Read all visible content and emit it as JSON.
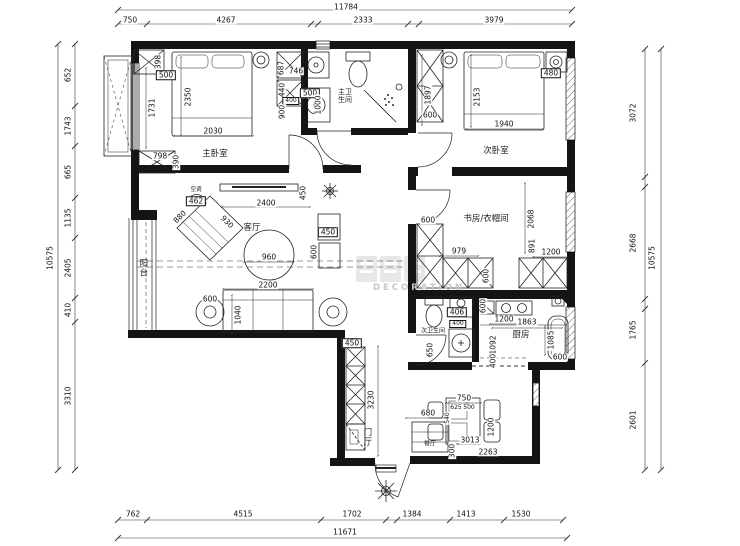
{
  "watermark": {
    "text": "DECORATION"
  },
  "rooms": [
    {
      "label": "主卧室",
      "x": 215,
      "y": 155,
      "cls": ""
    },
    {
      "label": "次卧室",
      "x": 496,
      "y": 152,
      "cls": ""
    },
    {
      "label": "主卫生间",
      "x": 345,
      "y": 96,
      "cls": "wrap"
    },
    {
      "label": "次卫生间",
      "x": 433,
      "y": 332,
      "cls": "sm"
    },
    {
      "label": "书房/衣帽间",
      "x": 486,
      "y": 220,
      "cls": ""
    },
    {
      "label": "厨房",
      "x": 521,
      "y": 336,
      "cls": ""
    },
    {
      "label": "客厅",
      "x": 252,
      "y": 229,
      "cls": ""
    },
    {
      "label": "餐厅",
      "x": 430,
      "y": 445,
      "cls": "sm"
    },
    {
      "label": "阳台",
      "x": 142,
      "y": 268,
      "cls": "vert"
    },
    {
      "label": "门厅",
      "x": 366,
      "y": 437,
      "cls": "vert"
    },
    {
      "label": "空调",
      "x": 196,
      "y": 190,
      "cls": "tiny"
    }
  ],
  "dims": [
    {
      "t": "11784",
      "x": 346,
      "y": 7
    },
    {
      "t": "750",
      "x": 130,
      "y": 20
    },
    {
      "t": "4267",
      "x": 226,
      "y": 20
    },
    {
      "t": "2333",
      "x": 363,
      "y": 20
    },
    {
      "t": "3979",
      "x": 494,
      "y": 20
    },
    {
      "t": "762",
      "x": 133,
      "y": 514
    },
    {
      "t": "4515",
      "x": 243,
      "y": 514
    },
    {
      "t": "1702",
      "x": 352,
      "y": 514
    },
    {
      "t": "1384",
      "x": 412,
      "y": 514
    },
    {
      "t": "1413",
      "x": 466,
      "y": 514
    },
    {
      "t": "1530",
      "x": 521,
      "y": 514
    },
    {
      "t": "11671",
      "x": 345,
      "y": 532
    },
    {
      "t": "652",
      "x": 68,
      "y": 75,
      "o": "v"
    },
    {
      "t": "1743",
      "x": 68,
      "y": 126,
      "o": "v"
    },
    {
      "t": "665",
      "x": 68,
      "y": 172,
      "o": "v"
    },
    {
      "t": "1135",
      "x": 68,
      "y": 218,
      "o": "v"
    },
    {
      "t": "2405",
      "x": 68,
      "y": 268,
      "o": "v"
    },
    {
      "t": "410",
      "x": 68,
      "y": 310,
      "o": "v"
    },
    {
      "t": "3310",
      "x": 68,
      "y": 396,
      "o": "v"
    },
    {
      "t": "10575",
      "x": 50,
      "y": 258,
      "o": "v"
    },
    {
      "t": "3072",
      "x": 633,
      "y": 113,
      "o": "v"
    },
    {
      "t": "2668",
      "x": 633,
      "y": 243,
      "o": "v"
    },
    {
      "t": "1765",
      "x": 633,
      "y": 330,
      "o": "v"
    },
    {
      "t": "2601",
      "x": 633,
      "y": 420,
      "o": "v"
    },
    {
      "t": "10575",
      "x": 652,
      "y": 258,
      "o": "v"
    },
    {
      "t": "398",
      "x": 158,
      "y": 62,
      "o": "v"
    },
    {
      "t": "500",
      "x": 166,
      "y": 75,
      "box": true
    },
    {
      "t": "1731",
      "x": 152,
      "y": 108,
      "o": "v"
    },
    {
      "t": "2350",
      "x": 188,
      "y": 97,
      "o": "v"
    },
    {
      "t": "2030",
      "x": 213,
      "y": 131
    },
    {
      "t": "798",
      "x": 160,
      "y": 156
    },
    {
      "t": "390",
      "x": 176,
      "y": 162,
      "o": "v"
    },
    {
      "t": "687",
      "x": 281,
      "y": 68,
      "o": "v"
    },
    {
      "t": "746",
      "x": 296,
      "y": 71
    },
    {
      "t": "440",
      "x": 282,
      "y": 90,
      "o": "v"
    },
    {
      "t": "400",
      "x": 291,
      "y": 101,
      "box": true,
      "s": true
    },
    {
      "t": "900",
      "x": 282,
      "y": 112,
      "o": "v"
    },
    {
      "t": "500",
      "x": 310,
      "y": 93,
      "box": true
    },
    {
      "t": "1000",
      "x": 318,
      "y": 105,
      "o": "v"
    },
    {
      "t": "1897",
      "x": 428,
      "y": 95,
      "o": "v"
    },
    {
      "t": "600",
      "x": 430,
      "y": 115
    },
    {
      "t": "2153",
      "x": 477,
      "y": 97,
      "o": "v"
    },
    {
      "t": "1940",
      "x": 504,
      "y": 124
    },
    {
      "t": "480",
      "x": 551,
      "y": 73,
      "box": true
    },
    {
      "t": "600",
      "x": 428,
      "y": 220
    },
    {
      "t": "2068",
      "x": 531,
      "y": 219,
      "o": "v"
    },
    {
      "t": "979",
      "x": 459,
      "y": 251
    },
    {
      "t": "891",
      "x": 532,
      "y": 246,
      "o": "v"
    },
    {
      "t": "1200",
      "x": 551,
      "y": 252
    },
    {
      "t": "600",
      "x": 486,
      "y": 276,
      "o": "v"
    },
    {
      "t": "450",
      "x": 303,
      "y": 193,
      "o": "v"
    },
    {
      "t": "2400",
      "x": 266,
      "y": 203
    },
    {
      "t": "462",
      "x": 196,
      "y": 201,
      "box": true
    },
    {
      "t": "880",
      "x": 180,
      "y": 217,
      "o": "d1"
    },
    {
      "t": "930",
      "x": 227,
      "y": 222,
      "o": "d2"
    },
    {
      "t": "960",
      "x": 269,
      "y": 257
    },
    {
      "t": "450",
      "x": 328,
      "y": 232,
      "box": true
    },
    {
      "t": "600",
      "x": 314,
      "y": 252,
      "o": "v"
    },
    {
      "t": "2200",
      "x": 268,
      "y": 285
    },
    {
      "t": "600",
      "x": 210,
      "y": 299
    },
    {
      "t": "1040",
      "x": 238,
      "y": 315,
      "o": "v"
    },
    {
      "t": "450",
      "x": 352,
      "y": 343,
      "box": true
    },
    {
      "t": "3230",
      "x": 371,
      "y": 400,
      "o": "v"
    },
    {
      "t": "406",
      "x": 457,
      "y": 312,
      "box": true
    },
    {
      "t": "400",
      "x": 458,
      "y": 324,
      "box": true,
      "s": true
    },
    {
      "t": "650",
      "x": 430,
      "y": 350,
      "o": "v"
    },
    {
      "t": "600",
      "x": 483,
      "y": 306,
      "o": "v"
    },
    {
      "t": "1200",
      "x": 504,
      "y": 319
    },
    {
      "t": "1863",
      "x": 527,
      "y": 322
    },
    {
      "t": "1092",
      "x": 493,
      "y": 345,
      "o": "v"
    },
    {
      "t": "400",
      "x": 493,
      "y": 361,
      "o": "v"
    },
    {
      "t": "1085",
      "x": 551,
      "y": 340,
      "o": "v"
    },
    {
      "t": "600",
      "x": 560,
      "y": 357
    },
    {
      "t": "680",
      "x": 428,
      "y": 413
    },
    {
      "t": "750",
      "x": 464,
      "y": 398
    },
    {
      "t": "625",
      "x": 456,
      "y": 408,
      "s": true
    },
    {
      "t": "500",
      "x": 469,
      "y": 408,
      "s": true
    },
    {
      "t": "540",
      "x": 448,
      "y": 418,
      "o": "v",
      "s": true
    },
    {
      "t": "1200",
      "x": 491,
      "y": 427,
      "o": "v"
    },
    {
      "t": "3013",
      "x": 470,
      "y": 440
    },
    {
      "t": "2263",
      "x": 488,
      "y": 452
    },
    {
      "t": "300",
      "x": 452,
      "y": 451,
      "o": "v"
    }
  ]
}
